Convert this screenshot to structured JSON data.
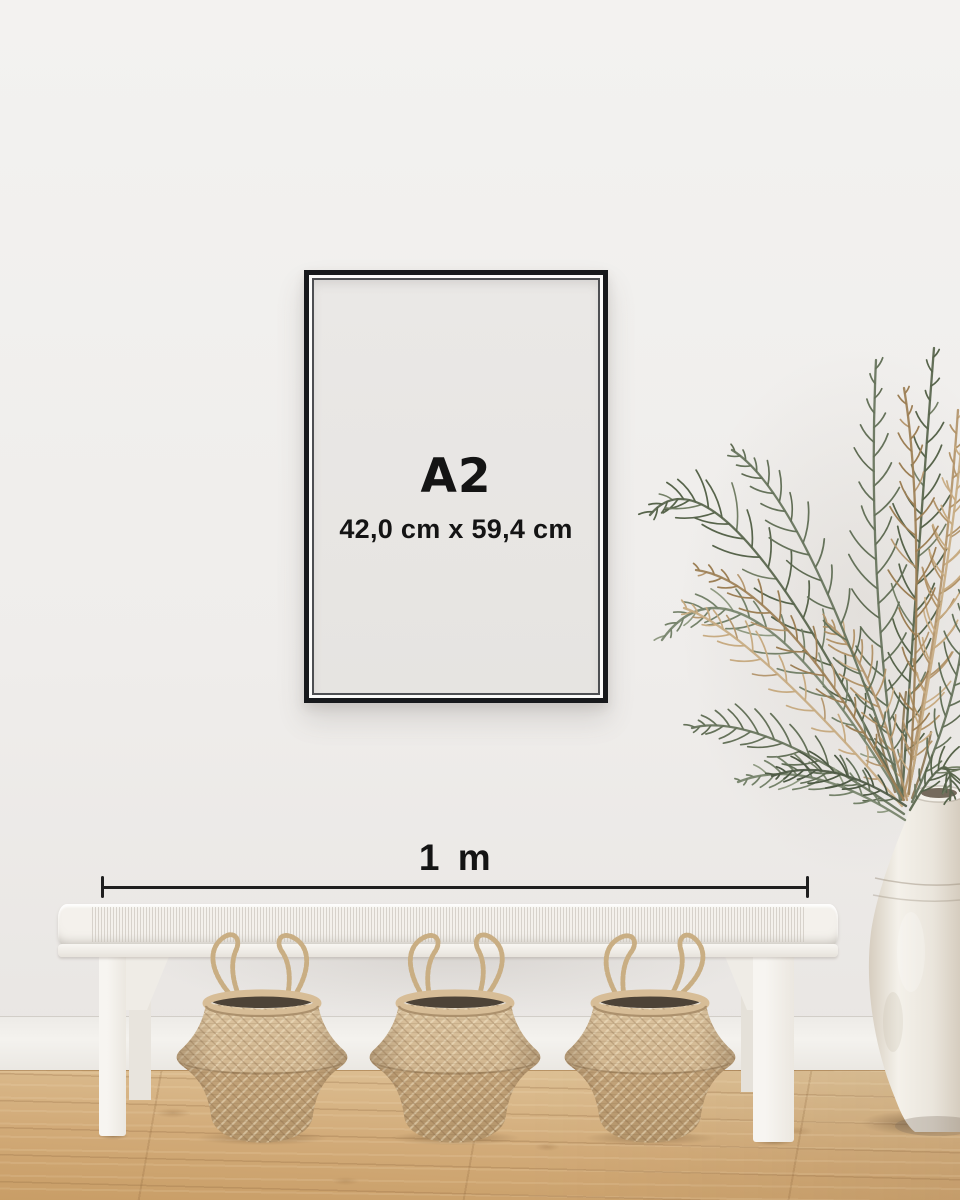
{
  "frame": {
    "size_label": "A2",
    "dimensions_label": "42,0 cm x 59,4 cm"
  },
  "measurement": {
    "label": "1 m"
  },
  "icons": {
    "plant": "dried-palm-plant",
    "vase": "ceramic-urn-vase",
    "bench": "white-woven-bench",
    "basket": "seagrass-belly-basket"
  },
  "colors": {
    "wall_top": "#f3f2f0",
    "wall_mid": "#efedeb",
    "wall_bottom": "#e8e5e2",
    "baseboard": "#f4f2ee",
    "floor_light": "#e0c59b",
    "floor_mid": "#d2ab79",
    "floor_dark": "#c89d66",
    "frame_border": "#17191c",
    "frame_mat": "#fbfbfa",
    "poster_top": "#eae8e6",
    "poster_bottom": "#e6e4e1",
    "ink": "#141414",
    "line": "#1f1f1f",
    "bench_white": "#f4f1ec",
    "bench_shade": "#e7e3dc",
    "basket_light": "#d7bd97",
    "basket_mid": "#c6a67c",
    "basket_dark": "#b3946a",
    "basket_interior": "#4d4337",
    "rope": "#c9ae83",
    "plant_green_dark": "#57644b",
    "plant_green": "#65725a",
    "plant_green_light": "#75826a",
    "plant_tan": "#b2946a",
    "plant_tan_light": "#c7ab82",
    "vase_light": "#f4f1ea",
    "vase_mid": "#eae5dc",
    "vase_shade": "#d6cdbf"
  }
}
